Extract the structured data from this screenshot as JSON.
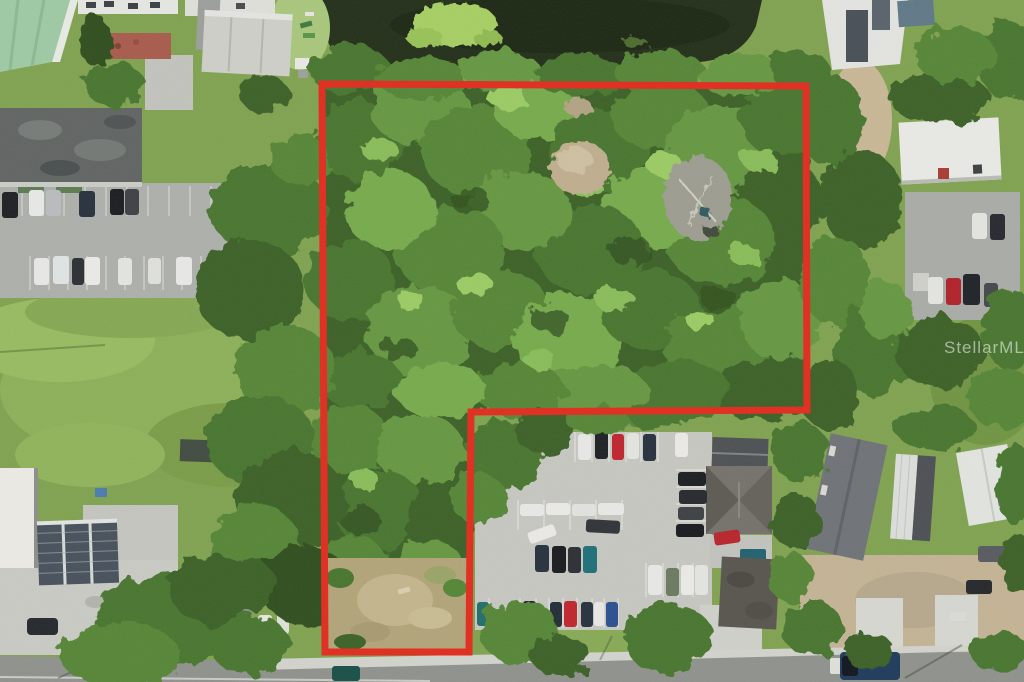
{
  "watermark": {
    "text": "StellarMLS",
    "color": "#ffffff"
  },
  "boundary": {
    "color": "#e22a1c",
    "stroke_width": "7",
    "points": "322,84 806,86 807,410 471,412 469,652 325,652"
  }
}
